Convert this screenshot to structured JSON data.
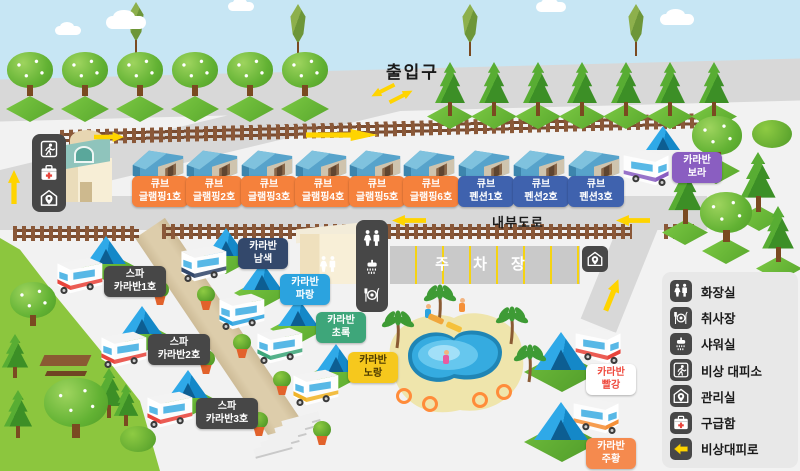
{
  "scene": {
    "entrance_label": "출입구",
    "internal_road_label": "내부도로",
    "parking_label": "주 차 장",
    "pool_label": "에어바운스 풀장"
  },
  "sites": [
    {
      "id": "glamping-1",
      "line1": "큐브",
      "line2": "글램핑1호",
      "bg": "#f5813c",
      "fg": "#ffffff"
    },
    {
      "id": "glamping-2",
      "line1": "큐브",
      "line2": "글램핑2호",
      "bg": "#f5813c",
      "fg": "#ffffff"
    },
    {
      "id": "glamping-3",
      "line1": "큐브",
      "line2": "글램핑3호",
      "bg": "#f5813c",
      "fg": "#ffffff"
    },
    {
      "id": "glamping-4",
      "line1": "큐브",
      "line2": "글램핑4호",
      "bg": "#f5813c",
      "fg": "#ffffff"
    },
    {
      "id": "glamping-5",
      "line1": "큐브",
      "line2": "글램핑5호",
      "bg": "#f5813c",
      "fg": "#ffffff"
    },
    {
      "id": "glamping-6",
      "line1": "큐브",
      "line2": "글램핑6호",
      "bg": "#f5813c",
      "fg": "#ffffff"
    },
    {
      "id": "pension-1",
      "line1": "큐브",
      "line2": "펜션1호",
      "bg": "#3f62ae",
      "fg": "#ffffff"
    },
    {
      "id": "pension-2",
      "line1": "큐브",
      "line2": "펜션2호",
      "bg": "#3f62ae",
      "fg": "#ffffff"
    },
    {
      "id": "pension-3",
      "line1": "큐브",
      "line2": "펜션3호",
      "bg": "#3f62ae",
      "fg": "#ffffff"
    }
  ],
  "caravans": [
    {
      "id": "spa-1",
      "line1": "스파",
      "line2": "카라반1호",
      "bg": "#474747",
      "fg": "#ffffff"
    },
    {
      "id": "spa-2",
      "line1": "스파",
      "line2": "카라반2호",
      "bg": "#474747",
      "fg": "#ffffff"
    },
    {
      "id": "spa-3",
      "line1": "스파",
      "line2": "카라반3호",
      "bg": "#474747",
      "fg": "#ffffff"
    },
    {
      "id": "navy",
      "line1": "카라반",
      "line2": "남색",
      "bg": "#33486b",
      "fg": "#ffffff"
    },
    {
      "id": "blue",
      "line1": "카라반",
      "line2": "파랑",
      "bg": "#2ba3df",
      "fg": "#ffffff"
    },
    {
      "id": "green",
      "line1": "카라반",
      "line2": "초록",
      "bg": "#3ea67a",
      "fg": "#ffffff"
    },
    {
      "id": "yellow",
      "line1": "카라반",
      "line2": "노랑",
      "bg": "#f6c81d",
      "fg": "#4a3800"
    },
    {
      "id": "purple",
      "line1": "카라반",
      "line2": "보라",
      "bg": "#8a5ec1",
      "fg": "#ffffff"
    },
    {
      "id": "red",
      "line1": "카라반",
      "line2": "빨강",
      "bg": "#ffffff",
      "fg": "#ef4b3f"
    },
    {
      "id": "orange",
      "line1": "카라반",
      "line2": "주황",
      "bg": "#f58a4e",
      "fg": "#ffffff"
    }
  ],
  "legend": {
    "items": [
      {
        "icon": "toilet-icon",
        "label": "화장실"
      },
      {
        "icon": "cooking-icon",
        "label": "취사장"
      },
      {
        "icon": "shower-icon",
        "label": "샤워실"
      },
      {
        "icon": "emergency-shelter-icon",
        "label": "비상 대피소"
      },
      {
        "icon": "office-icon",
        "label": "관리실"
      },
      {
        "icon": "first-aid-icon",
        "label": "구급함"
      },
      {
        "icon": "emergency-route-icon",
        "label": "비상대피로"
      }
    ]
  },
  "map_icons": {
    "building_panel": [
      "emergency-shelter-icon",
      "first-aid-icon",
      "office-icon"
    ],
    "facility_panel": [
      "toilet-icon",
      "shower-icon",
      "cooking-icon"
    ],
    "parking_badge": "office-icon"
  },
  "colors": {
    "road": "#d8d8d8",
    "ground": "#f2f2f2",
    "grass_hill": "#8cc63e",
    "fence": "#8a5838",
    "arrow_yellow": "#ffd400",
    "pool_water": "#35abe0",
    "pool_sand": "#efe5ac",
    "pad_green": "#6fc13d"
  }
}
